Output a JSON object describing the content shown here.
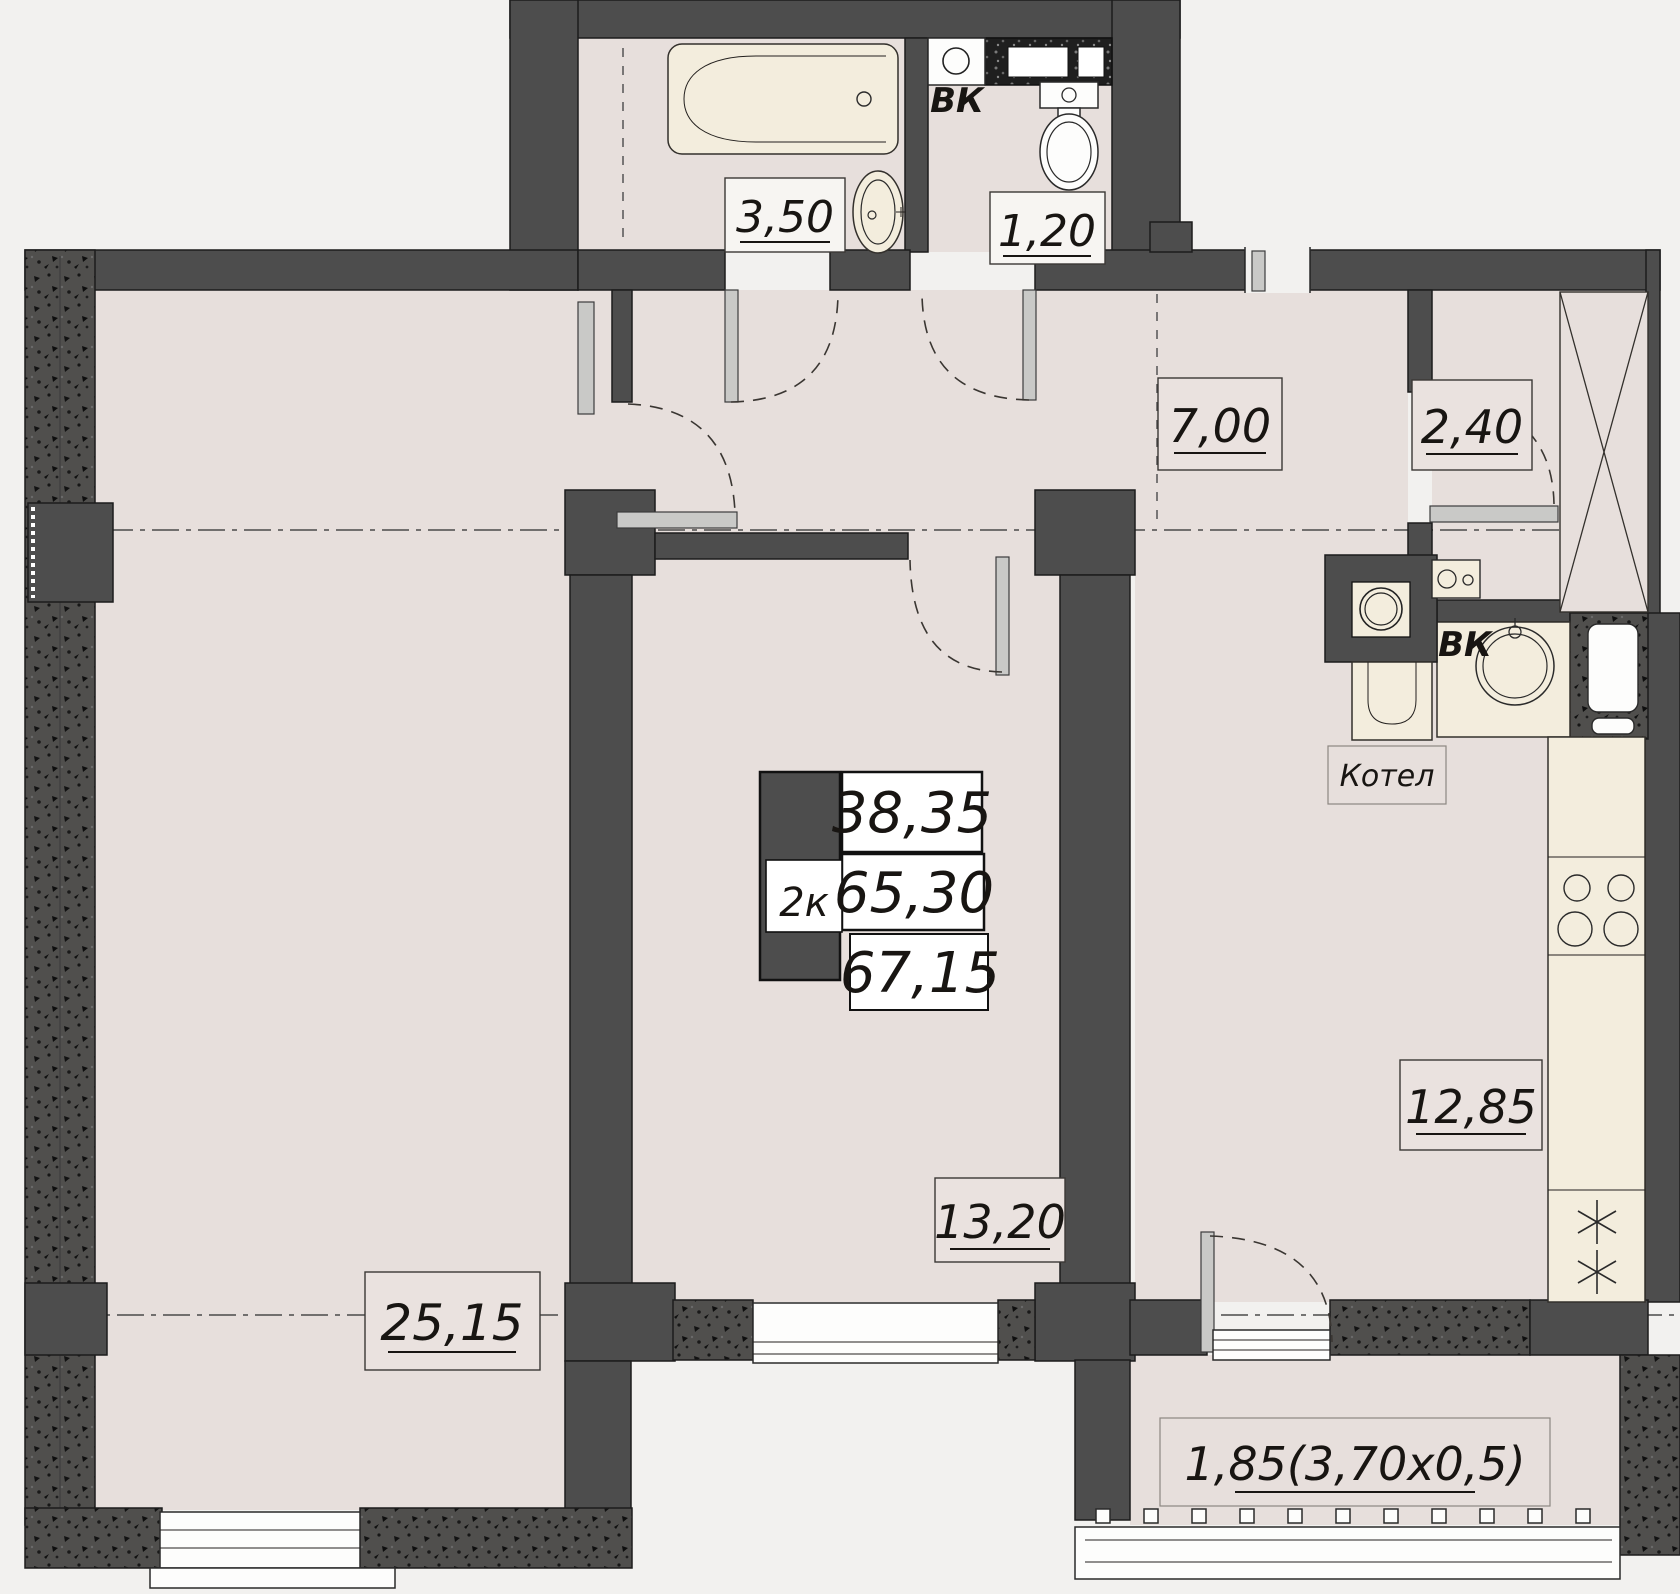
{
  "plan_title": "2-room apartment floor plan",
  "unit": {
    "type_label": "2к",
    "living_area": "38,35",
    "area_without_balcony": "65,30",
    "total_area": "67,15"
  },
  "rooms": {
    "bathroom": "3,50",
    "wc": "1,20",
    "hallway": "7,00",
    "closet": "2,40",
    "kitchen": "12,85",
    "bedroom": "13,20",
    "living_room": "25,15",
    "balcony": "1,85(3,70x0,5)"
  },
  "fixtures": {
    "riser_wc": "ВК",
    "riser_kitchen": "ВК",
    "boiler": "Котел"
  },
  "colors": {
    "background": "#f2f1ef",
    "floor": "#e7dfdc",
    "fixture_cream": "#f3eddd",
    "wall_dark": "#4d4d4d",
    "line": "#1f1f1f"
  }
}
